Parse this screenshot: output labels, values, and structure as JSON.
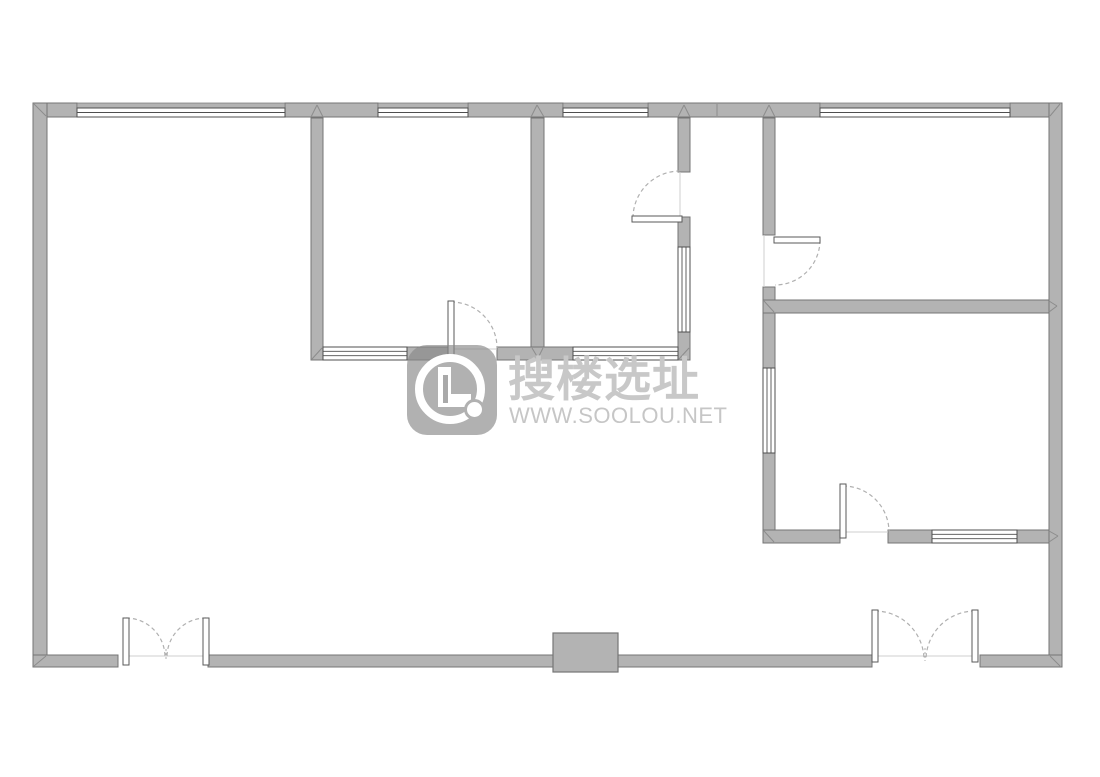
{
  "watermark": {
    "brand_text": "搜楼选址",
    "url_text": "WWW.SOOLOU.NET",
    "logo_letter": "L",
    "logo_color": "#898989",
    "brand_color": "#c8c8c8",
    "url_color": "#c6c6c6"
  },
  "floorplan": {
    "colors": {
      "background": "#ffffff",
      "wall_fill": "#b3b3b3",
      "wall_stroke": "#757575",
      "window_line": "#4f4f4f",
      "door_stroke": "#5a5a5a",
      "arc": "#b0b0b0",
      "joint": "#8c8c8c",
      "threshold": "#cfcfcf"
    },
    "walls": [
      [
        33,
        103,
        44,
        14
      ],
      [
        285,
        103,
        93,
        14
      ],
      [
        468,
        103,
        95,
        14
      ],
      [
        648,
        103,
        172,
        14
      ],
      [
        1010,
        103,
        52,
        14
      ],
      [
        33,
        103,
        14,
        564
      ],
      [
        1049,
        103,
        13,
        564
      ],
      [
        33,
        655,
        85,
        12
      ],
      [
        208,
        655,
        345,
        12
      ],
      [
        618,
        655,
        254,
        12
      ],
      [
        980,
        655,
        82,
        12
      ],
      [
        311,
        118,
        12,
        242
      ],
      [
        531,
        118,
        13,
        242
      ],
      [
        678,
        118,
        12,
        54
      ],
      [
        678,
        217,
        12,
        30
      ],
      [
        678,
        332,
        12,
        28
      ],
      [
        763,
        118,
        12,
        117
      ],
      [
        763,
        287,
        12,
        81
      ],
      [
        763,
        453,
        12,
        90
      ],
      [
        407,
        347,
        41,
        13
      ],
      [
        497,
        347,
        76,
        13
      ],
      [
        763,
        300,
        286,
        13
      ],
      [
        763,
        530,
        77,
        13
      ],
      [
        888,
        530,
        44,
        13
      ],
      [
        1017,
        530,
        32,
        13
      ]
    ],
    "windows_h": [
      {
        "r": [
          77,
          103,
          208,
          14
        ],
        "top_strip": true
      },
      {
        "r": [
          378,
          103,
          90,
          14
        ],
        "top_strip": true
      },
      {
        "r": [
          563,
          103,
          85,
          14
        ],
        "top_strip": true
      },
      {
        "r": [
          820,
          103,
          190,
          14
        ],
        "top_strip": true
      },
      {
        "r": [
          323,
          347,
          84,
          13
        ],
        "top_strip": false
      },
      {
        "r": [
          573,
          347,
          105,
          13
        ],
        "top_strip": false
      },
      {
        "r": [
          932,
          530,
          85,
          13
        ],
        "top_strip": false
      }
    ],
    "windows_v": [
      [
        678,
        247,
        12,
        85
      ],
      [
        763,
        368,
        12,
        85
      ]
    ],
    "doors": [
      {
        "leaf": [
          123,
          618,
          6,
          47
        ],
        "arc": "M126 618 A39 39 0 0 1 165 657"
      },
      {
        "leaf": [
          203,
          618,
          6,
          47
        ],
        "arc": "M206 618 A39 39 0 0 0 167 657"
      },
      {
        "leaf": [
          872,
          610,
          6,
          52
        ],
        "arc": "M875 611 A49 49 0 0 1 924 660"
      },
      {
        "leaf": [
          972,
          610,
          6,
          52
        ],
        "arc": "M975 611 A49 49 0 0 0 926 660"
      },
      {
        "leaf": [
          448,
          301,
          6,
          56
        ],
        "arc": "M451 302 A46 46 0 0 1 497 348"
      },
      {
        "leaf": [
          632,
          216,
          50,
          6
        ],
        "arc": "M633 218 A47 47 0 0 1 680 171"
      },
      {
        "leaf": [
          774,
          237,
          46,
          6
        ],
        "arc": "M820 240 A45 45 0 0 1 775 285"
      },
      {
        "leaf": [
          840,
          484,
          6,
          54
        ],
        "arc": "M843 486 A46 46 0 0 1 889 532"
      }
    ],
    "center_ticks": [
      [
        166,
        649,
        166,
        661
      ],
      [
        925,
        648,
        925,
        661
      ]
    ],
    "thresholds": [
      [
        129,
        656,
        203,
        656
      ],
      [
        878,
        656,
        972,
        656
      ],
      [
        454,
        349,
        497,
        349
      ],
      [
        846,
        532,
        888,
        532
      ],
      [
        680,
        172,
        680,
        217
      ],
      [
        764,
        235,
        764,
        287
      ]
    ],
    "joints": [
      [
        34,
        104,
        46,
        116
      ],
      [
        1060,
        104,
        1050,
        116
      ],
      [
        34,
        666,
        46,
        656
      ],
      [
        1060,
        666,
        1050,
        656
      ],
      [
        311,
        117,
        317,
        105
      ],
      [
        323,
        117,
        317,
        105
      ],
      [
        531,
        117,
        537,
        105
      ],
      [
        544,
        117,
        537,
        105
      ],
      [
        678,
        117,
        684,
        105
      ],
      [
        690,
        117,
        684,
        105
      ],
      [
        763,
        117,
        769,
        105
      ],
      [
        775,
        117,
        769,
        105
      ],
      [
        717,
        104,
        717,
        116
      ],
      [
        312,
        359,
        322,
        348
      ],
      [
        679,
        359,
        689,
        348
      ],
      [
        532,
        348,
        538,
        358
      ],
      [
        543,
        348,
        538,
        358
      ],
      [
        764,
        301,
        774,
        312
      ],
      [
        1049,
        301,
        1057,
        306
      ],
      [
        1049,
        312,
        1057,
        306
      ],
      [
        764,
        531,
        774,
        542
      ],
      [
        1049,
        531,
        1058,
        536
      ],
      [
        1049,
        542,
        1058,
        536
      ]
    ],
    "column": [
      553,
      633,
      65,
      39
    ]
  }
}
